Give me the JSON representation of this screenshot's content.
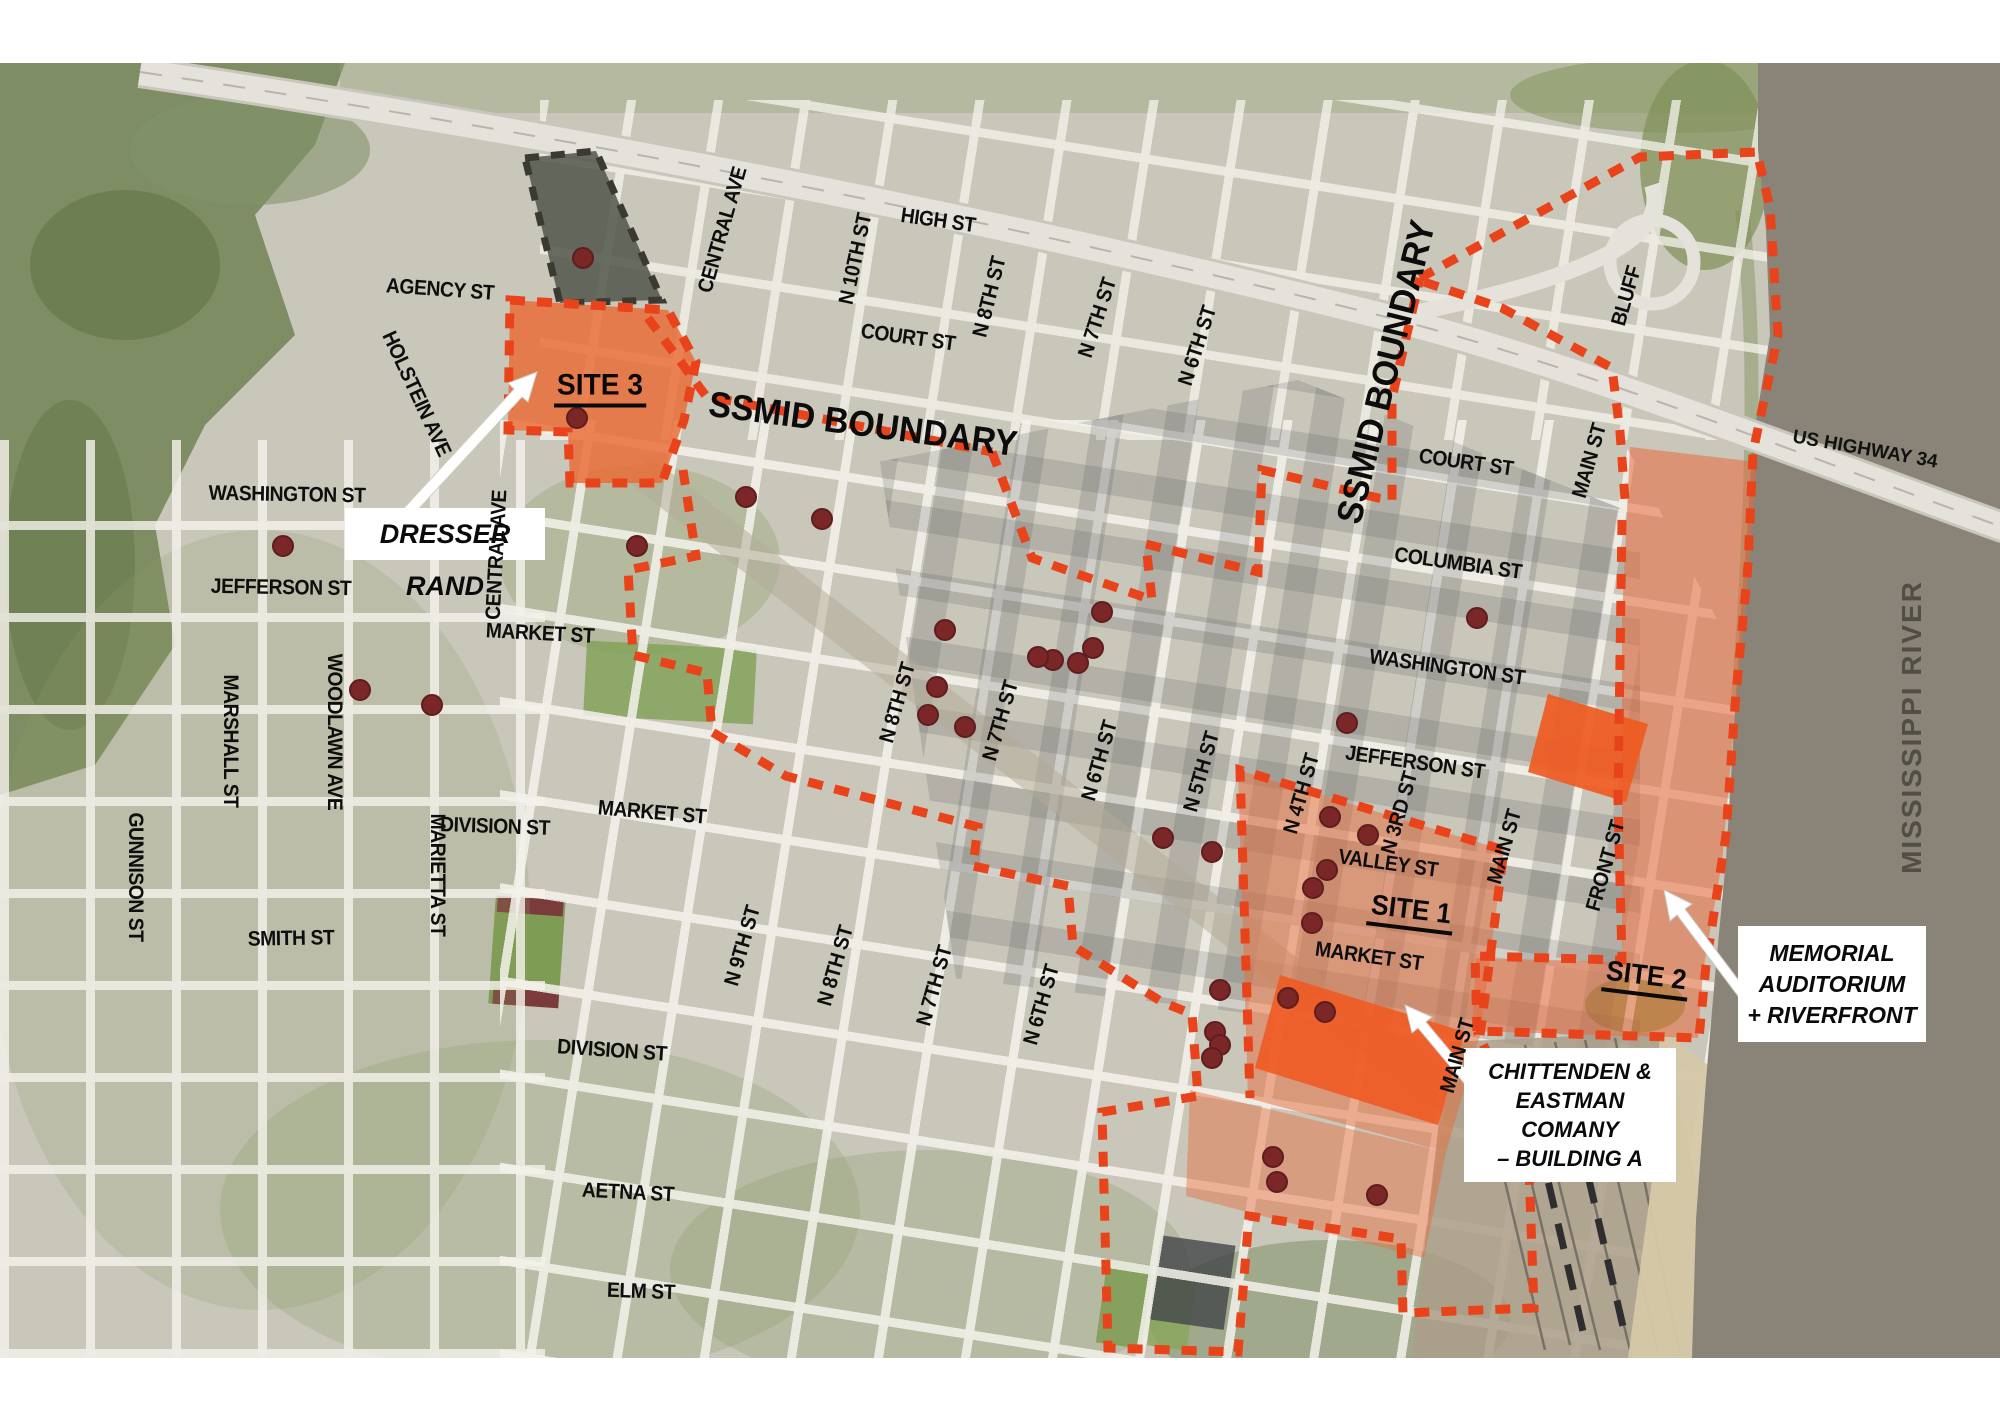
{
  "map": {
    "region_labels": {
      "river": "MISSISSIPPI RIVER",
      "highway": "US HIGHWAY 34"
    },
    "boundary_labels": [
      {
        "text": "SSMID BOUNDARY",
        "x": 863,
        "y": 424,
        "rot": 7.5
      },
      {
        "text": "SSMID BOUNDARY",
        "x": 1386,
        "y": 372,
        "rot": -76
      }
    ],
    "sites": [
      {
        "label": "SITE 3",
        "x": 600,
        "y": 388,
        "rot": 0
      },
      {
        "label": "SITE 1",
        "x": 1411,
        "y": 912,
        "rot": 7
      },
      {
        "label": "SITE 2",
        "x": 1646,
        "y": 978,
        "rot": 7
      }
    ],
    "callouts": {
      "dresser": {
        "lines": [
          "DRESSER RAND"
        ]
      },
      "memorial": {
        "lines": [
          "MEMORIAL",
          "AUDITORIUM",
          "+ RIVERFRONT"
        ]
      },
      "chittenden": {
        "lines": [
          "CHITTENDEN &",
          "EASTMAN COMANY",
          "– BUILDING A"
        ]
      }
    },
    "street_labels": [
      {
        "text": "AGENCY ST",
        "x": 440,
        "y": 290,
        "rot": 4
      },
      {
        "text": "HOLSTEIN AVE",
        "x": 416,
        "y": 394,
        "rot": 65
      },
      {
        "text": "CENTRAL AVE",
        "x": 723,
        "y": 230,
        "rot": -74
      },
      {
        "text": "CENTRAL AVE",
        "x": 497,
        "y": 555,
        "rot": -87
      },
      {
        "text": "WASHINGTON ST",
        "x": 287,
        "y": 495,
        "rot": 1
      },
      {
        "text": "JEFFERSON ST",
        "x": 281,
        "y": 588,
        "rot": 1
      },
      {
        "text": "MARSHALL ST",
        "x": 230,
        "y": 741,
        "rot": 90
      },
      {
        "text": "WOODLAWN AVE",
        "x": 334,
        "y": 732,
        "rot": 90
      },
      {
        "text": "GUNNISON ST",
        "x": 135,
        "y": 877,
        "rot": 90
      },
      {
        "text": "MARIETTA ST",
        "x": 437,
        "y": 875,
        "rot": 90
      },
      {
        "text": "SMITH ST",
        "x": 291,
        "y": 939,
        "rot": -1
      },
      {
        "text": "MARKET ST",
        "x": 540,
        "y": 634,
        "rot": 3
      },
      {
        "text": "MARKET ST",
        "x": 652,
        "y": 813,
        "rot": 5
      },
      {
        "text": "DIVISION ST",
        "x": 495,
        "y": 827,
        "rot": 2
      },
      {
        "text": "DIVISION ST",
        "x": 612,
        "y": 1051,
        "rot": 4
      },
      {
        "text": "AETNA ST",
        "x": 628,
        "y": 1193,
        "rot": 3
      },
      {
        "text": "ELM ST",
        "x": 641,
        "y": 1292,
        "rot": 2
      },
      {
        "text": "HIGH ST",
        "x": 938,
        "y": 221,
        "rot": 8
      },
      {
        "text": "COURT ST",
        "x": 908,
        "y": 338,
        "rot": 8
      },
      {
        "text": "N 10TH ST",
        "x": 856,
        "y": 259,
        "rot": -78
      },
      {
        "text": "N 8TH ST",
        "x": 990,
        "y": 297,
        "rot": -76
      },
      {
        "text": "N 7TH ST",
        "x": 1098,
        "y": 318,
        "rot": -72
      },
      {
        "text": "N 6TH ST",
        "x": 1198,
        "y": 346,
        "rot": -72
      },
      {
        "text": "N 9TH ST",
        "x": 743,
        "y": 946,
        "rot": -74
      },
      {
        "text": "N 8TH ST",
        "x": 836,
        "y": 966,
        "rot": -74
      },
      {
        "text": "N 7TH ST",
        "x": 935,
        "y": 986,
        "rot": -74
      },
      {
        "text": "N 6TH ST",
        "x": 1042,
        "y": 1005,
        "rot": -74
      },
      {
        "text": "N 8TH ST",
        "x": 898,
        "y": 703,
        "rot": -74
      },
      {
        "text": "N 7TH ST",
        "x": 1001,
        "y": 721,
        "rot": -74
      },
      {
        "text": "N 6TH ST",
        "x": 1100,
        "y": 761,
        "rot": -74
      },
      {
        "text": "N 5TH ST",
        "x": 1202,
        "y": 772,
        "rot": -74
      },
      {
        "text": "N 4TH ST",
        "x": 1302,
        "y": 794,
        "rot": -74
      },
      {
        "text": "N 3RD ST",
        "x": 1400,
        "y": 813,
        "rot": -74
      },
      {
        "text": "MAIN ST",
        "x": 1505,
        "y": 847,
        "rot": -74
      },
      {
        "text": "FRONT ST",
        "x": 1606,
        "y": 866,
        "rot": -74
      },
      {
        "text": "MAIN ST",
        "x": 1590,
        "y": 461,
        "rot": -74
      },
      {
        "text": "MAIN ST",
        "x": 1458,
        "y": 1056,
        "rot": -74
      },
      {
        "text": "BLUFF",
        "x": 1627,
        "y": 296,
        "rot": -74
      },
      {
        "text": "COURT ST",
        "x": 1466,
        "y": 463,
        "rot": 8
      },
      {
        "text": "COLUMBIA ST",
        "x": 1458,
        "y": 564,
        "rot": 8
      },
      {
        "text": "WASHINGTON ST",
        "x": 1447,
        "y": 668,
        "rot": 8
      },
      {
        "text": "JEFFERSON ST",
        "x": 1415,
        "y": 763,
        "rot": 8
      },
      {
        "text": "VALLEY ST",
        "x": 1388,
        "y": 864,
        "rot": 8
      },
      {
        "text": "MARKET ST",
        "x": 1369,
        "y": 957,
        "rot": 8
      }
    ],
    "building_markers": [
      [
        583,
        258
      ],
      [
        283,
        546
      ],
      [
        577,
        418
      ],
      [
        637,
        546
      ],
      [
        360,
        690
      ],
      [
        432,
        705
      ],
      [
        746,
        497
      ],
      [
        822,
        519
      ],
      [
        945,
        630
      ],
      [
        1102,
        612
      ],
      [
        1093,
        648
      ],
      [
        1078,
        663
      ],
      [
        1053,
        660
      ],
      [
        1038,
        657
      ],
      [
        937,
        687
      ],
      [
        928,
        715
      ],
      [
        965,
        727
      ],
      [
        1163,
        838
      ],
      [
        1212,
        852
      ],
      [
        1347,
        723
      ],
      [
        1477,
        618
      ],
      [
        1330,
        817
      ],
      [
        1368,
        835
      ],
      [
        1327,
        870
      ],
      [
        1313,
        888
      ],
      [
        1312,
        923
      ],
      [
        1288,
        998
      ],
      [
        1220,
        990
      ],
      [
        1325,
        1012
      ],
      [
        1215,
        1032
      ],
      [
        1220,
        1045
      ],
      [
        1212,
        1058
      ],
      [
        1273,
        1157
      ],
      [
        1277,
        1182
      ],
      [
        1377,
        1195
      ]
    ],
    "colors": {
      "boundary_dash": "#e8431a",
      "site_fill": "#e86a3a",
      "site_fill_bright": "#f05a22",
      "river": "#8a8478",
      "marker": "#7b2727",
      "facility_boundary": "#3a3a32",
      "label_text": "#0e0e0e"
    }
  }
}
